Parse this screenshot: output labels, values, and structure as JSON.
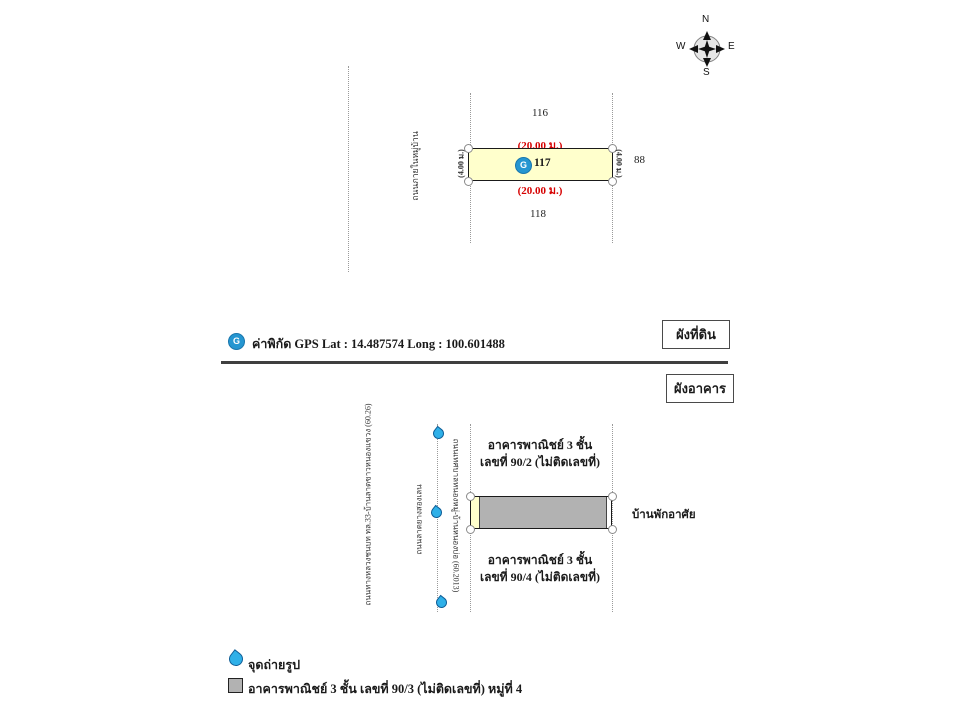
{
  "compass": {
    "north": "N",
    "east": "E",
    "south": "S",
    "west": "W"
  },
  "land_plan": {
    "section_label": "ผังที่ดิน",
    "road_label": "ถนนภายในหมู่บ้าน",
    "parcel_north": "116",
    "parcel_number": "117",
    "parcel_south": "118",
    "parcel_east": "88",
    "dim_top": "(20.00 ม.)",
    "dim_bottom": "(20.00 ม.)",
    "dim_left": "(4.00 ม.)",
    "dim_right": "(4.00 ม.)",
    "gps_marker_letter": "G",
    "gps_caption": "ค่าพิกัด GPS Lat : 14.487574  Long : 100.601488"
  },
  "building_plan": {
    "section_label": "ผังอาคาร",
    "road_left": "ถนนทางหลวงชนบท ทล.33-บ้านลาดขาวหนองแขวง (60.26)",
    "road_middle": "ถนนลาดยางสองเลน",
    "road_right": "ถนนเทศบาลหนองหมู่-บ้านหนองบ่อ (60.2013)",
    "building_north_line1": "อาคารพาณิชย์ 3 ชั้น",
    "building_north_line2": "เลขที่ 90/2 (ไม่ติดเลขที่)",
    "building_south_line1": "อาคารพาณิชย์ 3 ชั้น",
    "building_south_line2": "เลขที่ 90/4 (ไม่ติดเลขที่)",
    "east_neighbor": "บ้านพักอาศัย"
  },
  "legend": {
    "photo_point_label": "จุดถ่ายรูป",
    "building_label": "อาคารพาณิชย์ 3 ชั้น  เลขที่ 90/3 (ไม่ติดเลขที่) หมู่ที่ 4"
  },
  "colors": {
    "dimension_red": "#d60000",
    "parcel_fill": "#ffffcc",
    "building_fill": "#b2b2b2",
    "gps_marker_blue": "#2596d1",
    "photo_point_blue": "#2fb0e8",
    "divider": "#3f3f3f"
  }
}
